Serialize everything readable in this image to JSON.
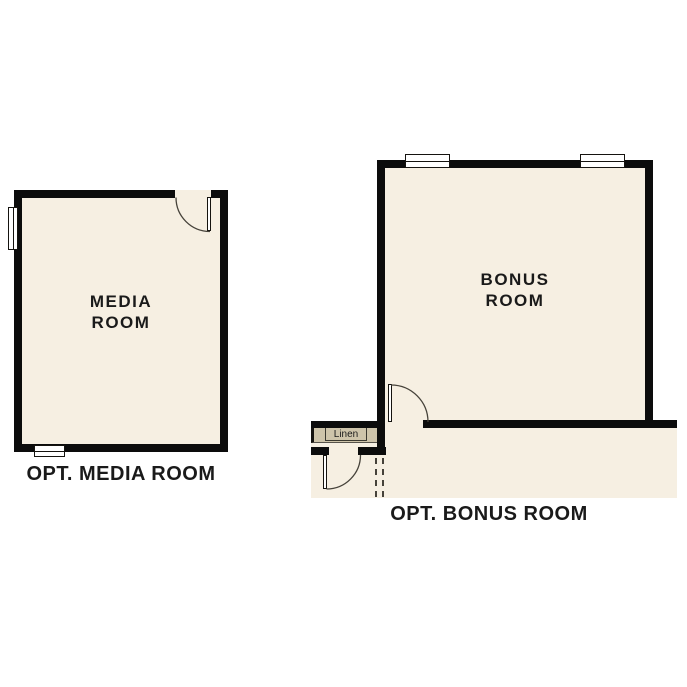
{
  "colors": {
    "wall": "#0c0c0c",
    "floor": "#f6efe2",
    "shelf": "#cec4aa",
    "window": "#ffffff",
    "line": "#46423a",
    "text": "#1a1a1a",
    "background": "#ffffff"
  },
  "media_room": {
    "label": "MEDIA\nROOM",
    "caption": "OPT. MEDIA ROOM"
  },
  "bonus_room": {
    "label": "BONUS\nROOM",
    "caption": "OPT. BONUS ROOM",
    "closet_label": "Linen"
  }
}
